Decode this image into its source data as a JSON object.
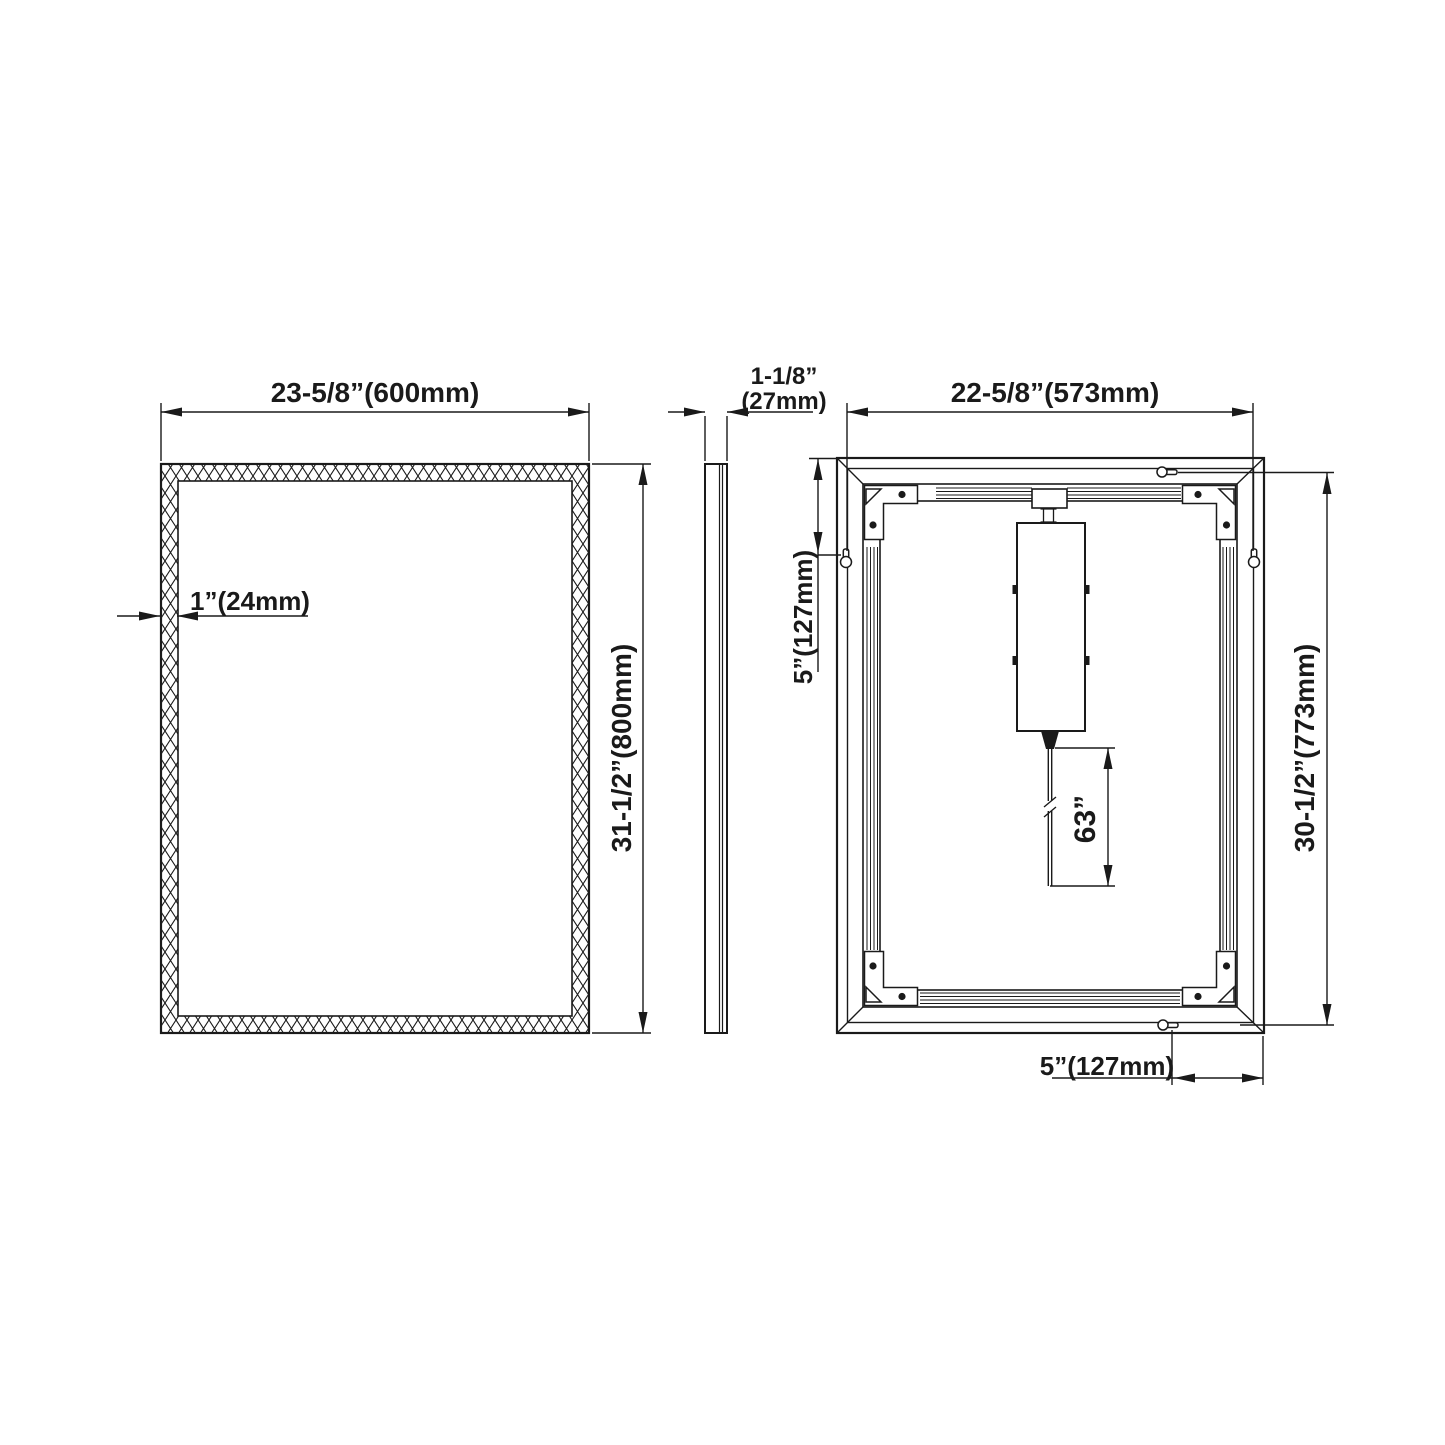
{
  "drawing": {
    "type": "technical-dimension-drawing",
    "subject": "LED mirror — front, side and back views",
    "background_color": "#ffffff",
    "line_color": "#1a1a1a",
    "views": {
      "front": {
        "name": "front view",
        "label_width": "23-5/8”(600mm)",
        "label_height": "31-1/2”(800mm)",
        "label_frame": "1”(24mm)"
      },
      "side": {
        "name": "side view",
        "label_depth_inches": "1-1/8”",
        "label_depth_mm": "(27mm)"
      },
      "back": {
        "name": "back view",
        "label_width": "22-5/8”(573mm)",
        "label_height": "30-1/2”(773mm)",
        "label_hanger_top_offset": "5”(127mm)",
        "label_hanger_side_offset": "5”(127mm)",
        "label_cord_length": "63”"
      }
    }
  }
}
